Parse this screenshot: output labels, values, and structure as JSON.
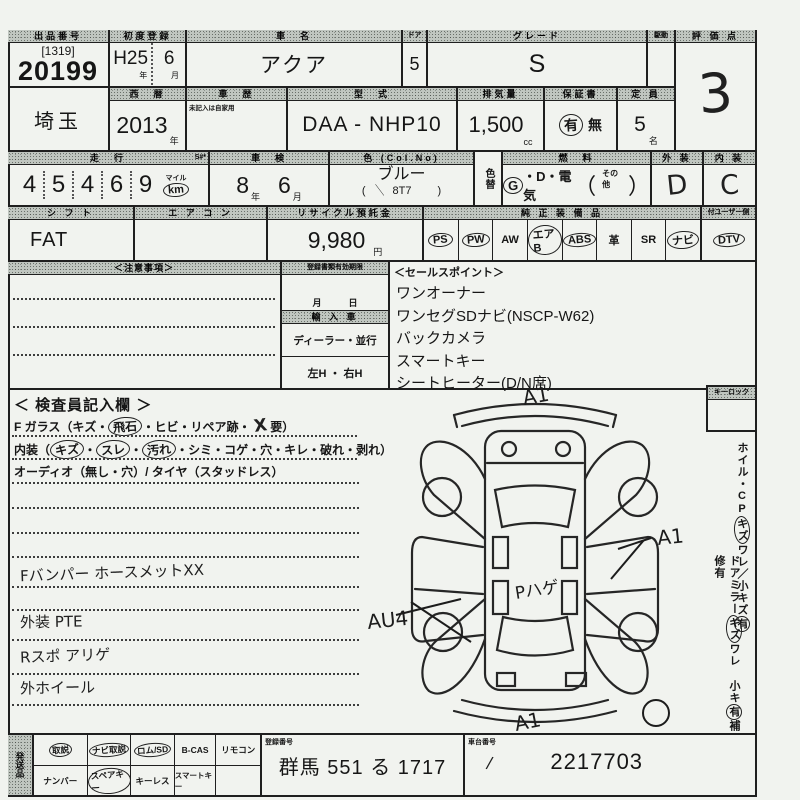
{
  "paper_color": "#f1f3ef",
  "ink_color": "#1f1f1f",
  "header": {
    "lot_label": "出品番号",
    "lot_bracket": "[1319]",
    "lot_no": "20199",
    "first_reg_label": "初度登録",
    "first_reg_a": "H25",
    "first_reg_b": "6",
    "first_reg_unit_a": "年",
    "first_reg_unit_b": "月",
    "name_label": "車　名",
    "name": "アクア",
    "door_label": "ドア",
    "door": "5",
    "grade_label": "グレード",
    "grade": "S",
    "drive_label": "駆動",
    "score_label": "評 価 点",
    "score": "3"
  },
  "reg": {
    "region": "埼玉",
    "year_label": "西　暦",
    "year": "2013",
    "year_unit": "年",
    "history_label": "車　歴",
    "history_note": "未記入は自家用",
    "model_label": "型　式",
    "model": "DAA -  NHP10",
    "cc_label": "排気量",
    "cc": "1,500",
    "cc_unit": "cc",
    "warranty_label": "保証書",
    "warranty_yes": "有",
    "warranty_no": "無",
    "seats_label": "定 員",
    "seats": "5",
    "seats_unit": "名"
  },
  "run": {
    "label": "走　行",
    "s_mark": "S#*",
    "digits": "45469",
    "unit_mile": "マイル",
    "unit_km": "km",
    "shaken_label": "車　検",
    "shaken_year": "8",
    "shaken_year_unit": "年",
    "shaken_month": "6",
    "shaken_month_unit": "月",
    "color_label": "色 (Col.No)",
    "color": "ブルー",
    "code_l": "(",
    "color_check": "＼",
    "color_code": "8T7",
    "code_r": ")",
    "color_change_label": "色替",
    "fuel_label": "燃　料",
    "fuel_g": "G",
    "fuel_rest": "・D・電気",
    "paren_l": "（",
    "fuel_other": "その他",
    "paren_r": "）",
    "ext_label": "外 装",
    "ext": "D",
    "int_label": "内 装",
    "int": "C"
  },
  "row4": {
    "shift_label": "シ フ ト",
    "shift": "FAT",
    "ac_label": "エ ア コ ン",
    "recycle_label": "リサイクル預託金",
    "recycle": "9,980",
    "recycle_unit": "円",
    "equip_label": "純 正 装 備 品",
    "equip_sub_label": "付ユーザー側",
    "items": [
      {
        "label": "PS",
        "circled": true
      },
      {
        "label": "PW",
        "circled": true
      },
      {
        "label": "AW",
        "circled": false
      },
      {
        "label": "エアB",
        "circled": true
      },
      {
        "label": "ABS",
        "circled": true
      },
      {
        "label": "革",
        "circled": false
      },
      {
        "label": "SR",
        "circled": false
      },
      {
        "label": "ナビ",
        "circled": true
      },
      {
        "label": "DTV",
        "circled": true
      }
    ]
  },
  "mid": {
    "notice_title": "＜注意事項＞",
    "docs_label": "登録書類有効期限",
    "docs_units": "月　　　日",
    "import_label": "輸 入 車",
    "import_value": "ディーラー・並行",
    "handle_value": "左H ・ 右H",
    "sales_title": "＜セールスポイント＞",
    "sales_items": [
      "ワンオーナー",
      "ワンセグSDナビ(NSCP-W62)",
      "バックカメラ",
      "スマートキー",
      "シートヒーター(D/N席)"
    ]
  },
  "inspector": {
    "title": "＜ 検査員記入欄 ＞",
    "glass_pre": "F ガラス（キズ・",
    "glass_circ": "飛石",
    "glass_mid": "・ヒビ・リペア跡・",
    "glass_hand": "X",
    "glass_post": "要）",
    "interior_pre": "内装（",
    "dot": "・",
    "int_c1": "キズ",
    "int_c2": "スレ",
    "int_c3": "汚れ",
    "interior_post": "・シミ・コゲ・穴・キレ・破れ・剥れ）",
    "audio": "オーディオ（無し・穴）/ タイヤ（スタッドレス）",
    "notes": [
      "Fバンパー ホースメットXX",
      "外装 PTE",
      "Rスポ アリゲ",
      "外ホイール"
    ]
  },
  "diagram": {
    "mark_top": "A1",
    "mark_right": "A1",
    "mark_left": "AU4",
    "mark_center": "Pハゲ",
    "mark_bottom": "A1"
  },
  "side": {
    "keylock": "キーロック",
    "c1a": "ホイル・CP",
    "c1b": "キズ",
    "c1c": "ワレ／小キズ",
    "c1d": "有",
    "c2a": "ドアミラー",
    "c2b": "キズ",
    "c2c": "ワレ 小キ",
    "c2d": "有",
    "c2e": "補修有"
  },
  "bottom": {
    "ship_label": "発送品",
    "r1": [
      {
        "label": "取説",
        "circled": true
      },
      {
        "label": "ナビ取説",
        "circled": true
      },
      {
        "label": "ロム/SD",
        "circled": true
      },
      {
        "label": "B-CAS",
        "circled": false
      },
      {
        "label": "リモコン",
        "circled": false
      }
    ],
    "r2": [
      {
        "label": "ナンバー",
        "circled": false
      },
      {
        "label": "スペアキー",
        "circled": true
      },
      {
        "label": "キーレス",
        "circled": false
      },
      {
        "label": "スマートキー",
        "circled": false
      }
    ],
    "plate_label": "登録番号",
    "plate": "群馬 551 る 1717",
    "chassis_label": "車台番号",
    "chassis_check": "/",
    "chassis": "2217703"
  }
}
